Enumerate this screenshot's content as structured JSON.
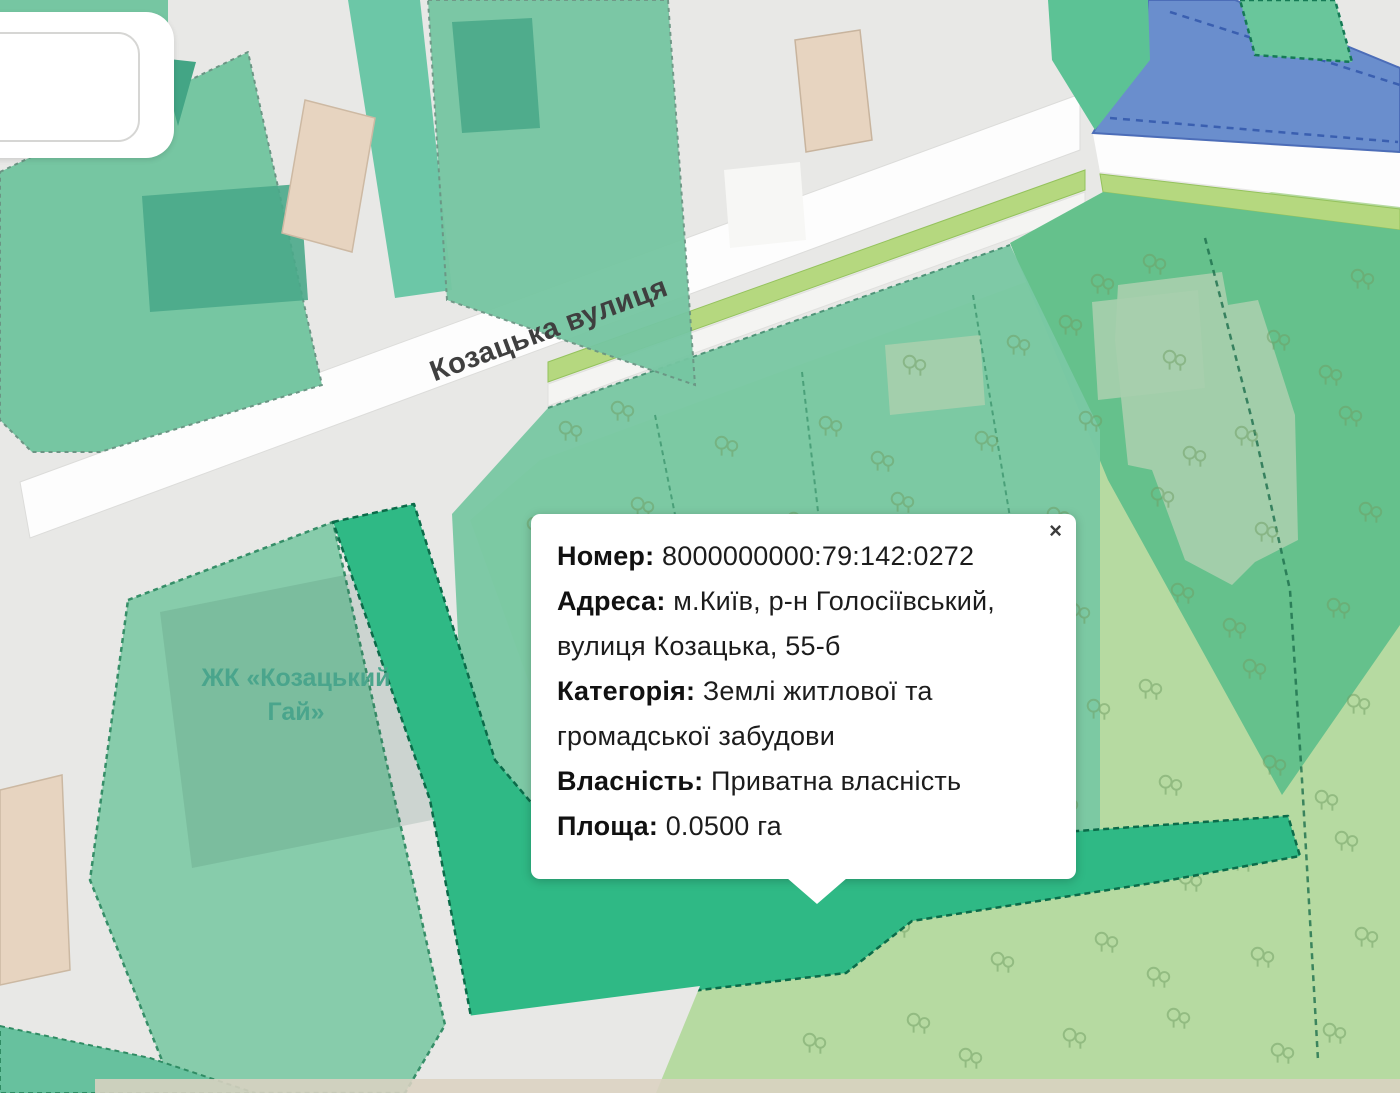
{
  "map": {
    "street_label": "Козацька вулиця",
    "complex_label": {
      "line1": "ЖК «Козацький",
      "line2": "Гай»"
    },
    "colors": {
      "background": "#e8e8e6",
      "road": "#fdfdfd",
      "driveway": "#f7f7f5",
      "sidewalk": "#f4f4f2",
      "verge_lime": "#b5d87f",
      "forest": "#b6daa1",
      "parcel_green": "#65c18c",
      "parcel_teal_band": "#7ac8a3",
      "parcel_teal": "#76c6a2",
      "parcel_teal_light": "#84cba9",
      "parcel_selected": "#2fb985",
      "strip_green": "#5cc295",
      "corner_green": "#69c69b",
      "corner_teal": "#67c19e",
      "path_strip": "#5ec3a0",
      "blue_zone": "#6a8ecd",
      "blue_zone_line": "#3a5fb0",
      "building_teal": "#4aa98a",
      "building_teal_dark": "#43a585",
      "building_beige": "#e7d4c0",
      "footprint_light": "#a7cfad",
      "bottom_beige": "#dbd2c2",
      "gray_area": "#e8e8e6",
      "tree": "#6f9e63",
      "street_text": "#3f3f3f",
      "complex_text": "#4aa58c"
    }
  },
  "popup": {
    "close_glyph": "×",
    "fields": [
      {
        "label": "Номер:",
        "value": "8000000000:79:142:0272"
      },
      {
        "label": "Адреса:",
        "value": "м.Київ, р-н Голосіївський, вулиця Козацька, 55-б"
      },
      {
        "label": "Категорія:",
        "value": "Землі житлової та громадської забудови"
      },
      {
        "label": "Власність:",
        "value": "Приватна власність"
      },
      {
        "label": "Площа:",
        "value": "0.0500 га"
      }
    ]
  }
}
